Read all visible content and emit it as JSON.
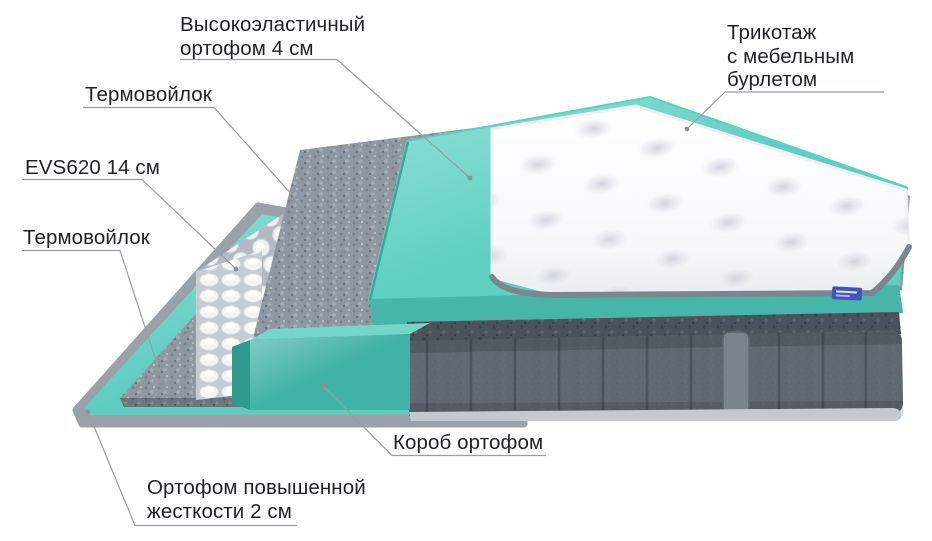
{
  "diagram": {
    "labels": {
      "elastic_foam": {
        "lines": [
          "Высокоэластичный",
          "ортофом 4 см"
        ]
      },
      "knit_cover": {
        "lines": [
          "Трикотаж",
          "с мебельным",
          "бурлетом"
        ]
      },
      "felt_top": {
        "lines": [
          "Термовойлок"
        ]
      },
      "springs": {
        "lines": [
          "EVS620 14 см"
        ]
      },
      "felt_bottom": {
        "lines": [
          "Термовойлок"
        ]
      },
      "foam_box": {
        "lines": [
          "Короб ортофом"
        ]
      },
      "hard_foam": {
        "lines": [
          "Ортофом повышенной",
          "жесткости 2 см"
        ]
      }
    },
    "colors": {
      "background": "#ffffff",
      "teal_sheet": "#5ecdc0",
      "teal_slab_top": "#5dd0c2",
      "teal_slab_front": "#46b6a9",
      "box_front": "#41b2a6",
      "box_top": "#74d6c9",
      "box_left": "#2f998d",
      "felt": "#8f98a2",
      "felt_edge": "#6d7680",
      "felt_dark": "#4a535d",
      "fabric": "#5a626c",
      "fabric_seam": "#454d57",
      "handle": "#7b838d",
      "base_strip": "#c3c9cf",
      "rim": "#9aa1a9",
      "quilt": "#fafbfd",
      "piping": "#7e858f",
      "badge": "#4353b8",
      "leader": "#979da5",
      "dot": "#8b9199",
      "text": "#1e2126"
    }
  }
}
